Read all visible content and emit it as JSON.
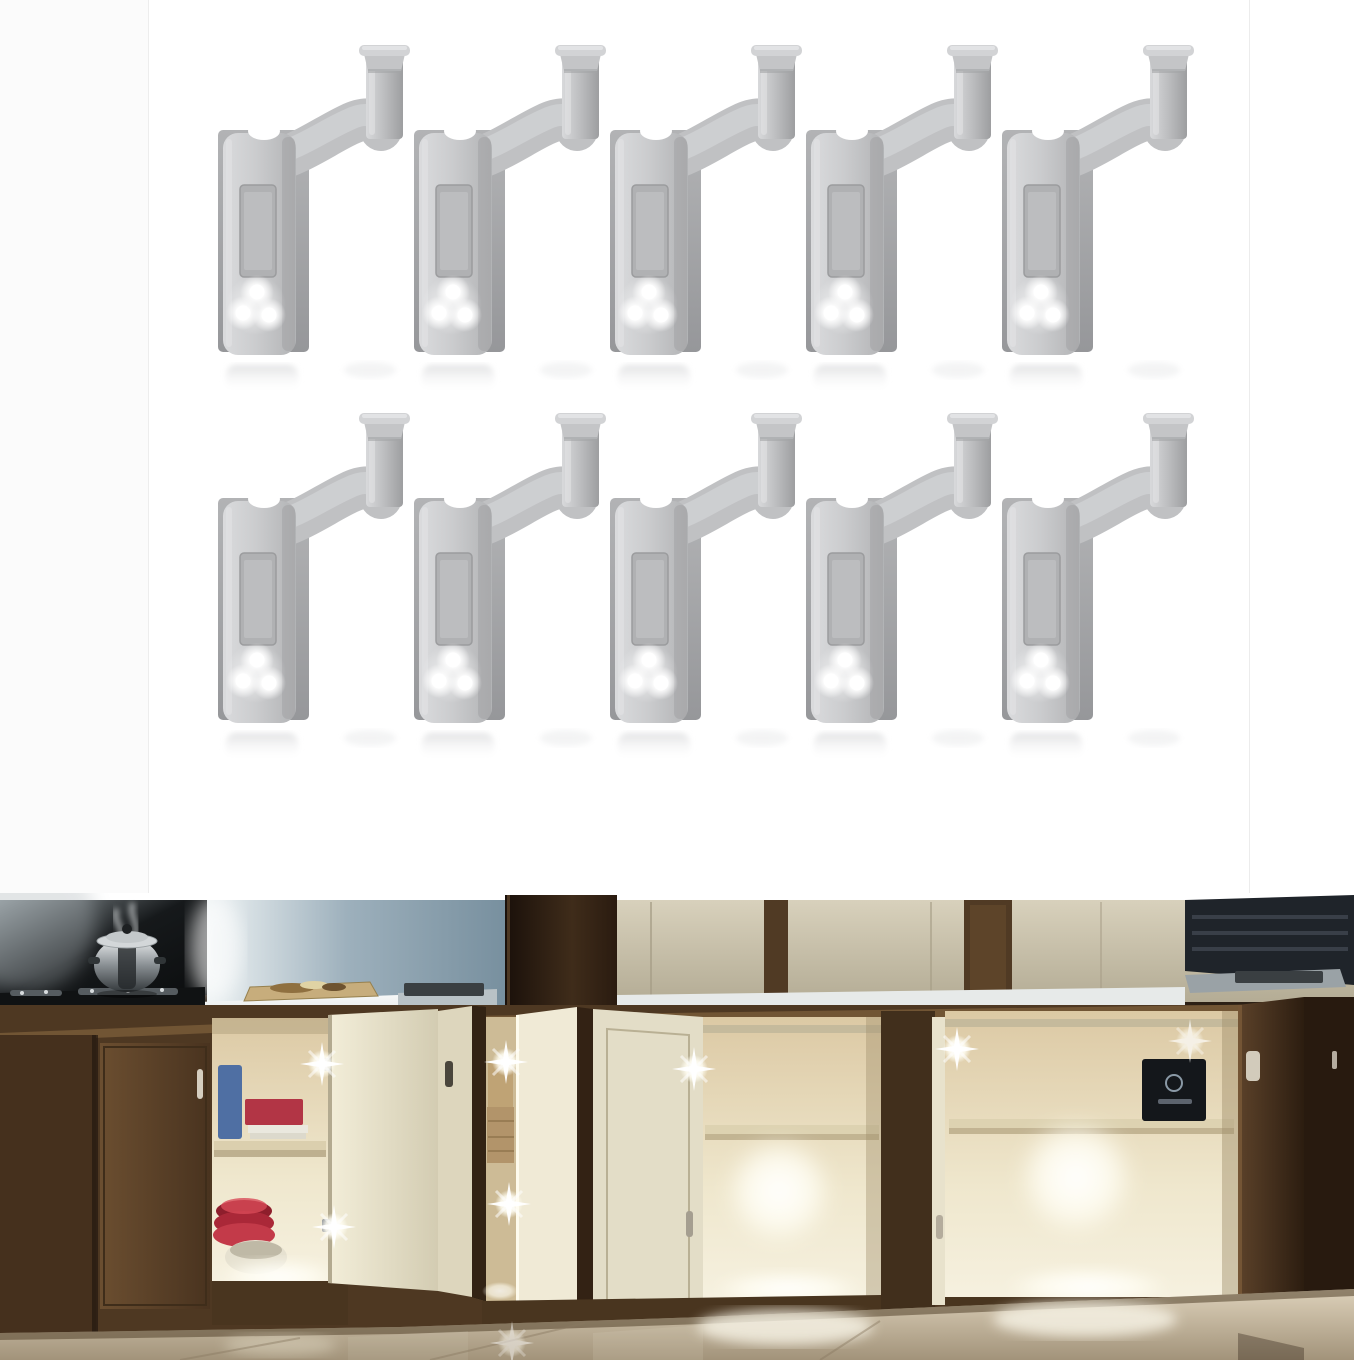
{
  "page": {
    "aria_label": "Product listing image: LED cabinet cupboard hinge lights",
    "background": "#ffffff"
  },
  "product_panel": {
    "aria_label": "Product photo: ten grey LED cabinet hinge lights arranged in two rows of five on a white background",
    "grid": {
      "rows": 2,
      "cols": 5,
      "count": 10
    },
    "item": {
      "name": "LED hinge light",
      "led_count": 3
    },
    "colors": {
      "body": "#c9cacc",
      "body_highlight": "#dcddde",
      "backing_plate": "#a5a6a8",
      "recessed_panel": "#b0b1b3",
      "led": "#ffffff",
      "background": "#ffffff",
      "side_margin": "#fbfbfb"
    }
  },
  "kitchen_panel": {
    "aria_label": "Demo photo: kitchen with wooden base cabinets, doors open, interiors illuminated by white LED hinge lights; steel pot steaming on black cooktop at left; glossy reflective floor",
    "led_glints_visible": 7,
    "colors": {
      "wood_frame": "#4b3621",
      "dark_wood": "#2a1c11",
      "cabinet_interior": "#f0e9d3",
      "interior_glow": "#fffef4",
      "upper_cabinet_cream": "#cdc6b1",
      "wall_blue_grey": "#8aa0af",
      "cooktop_black": "#0d0f10",
      "counter_white": "#eef1f1",
      "floor_beige": "#c9bba1",
      "led_glint": "#ffffff",
      "red_dishes": "#b02c3c"
    }
  }
}
